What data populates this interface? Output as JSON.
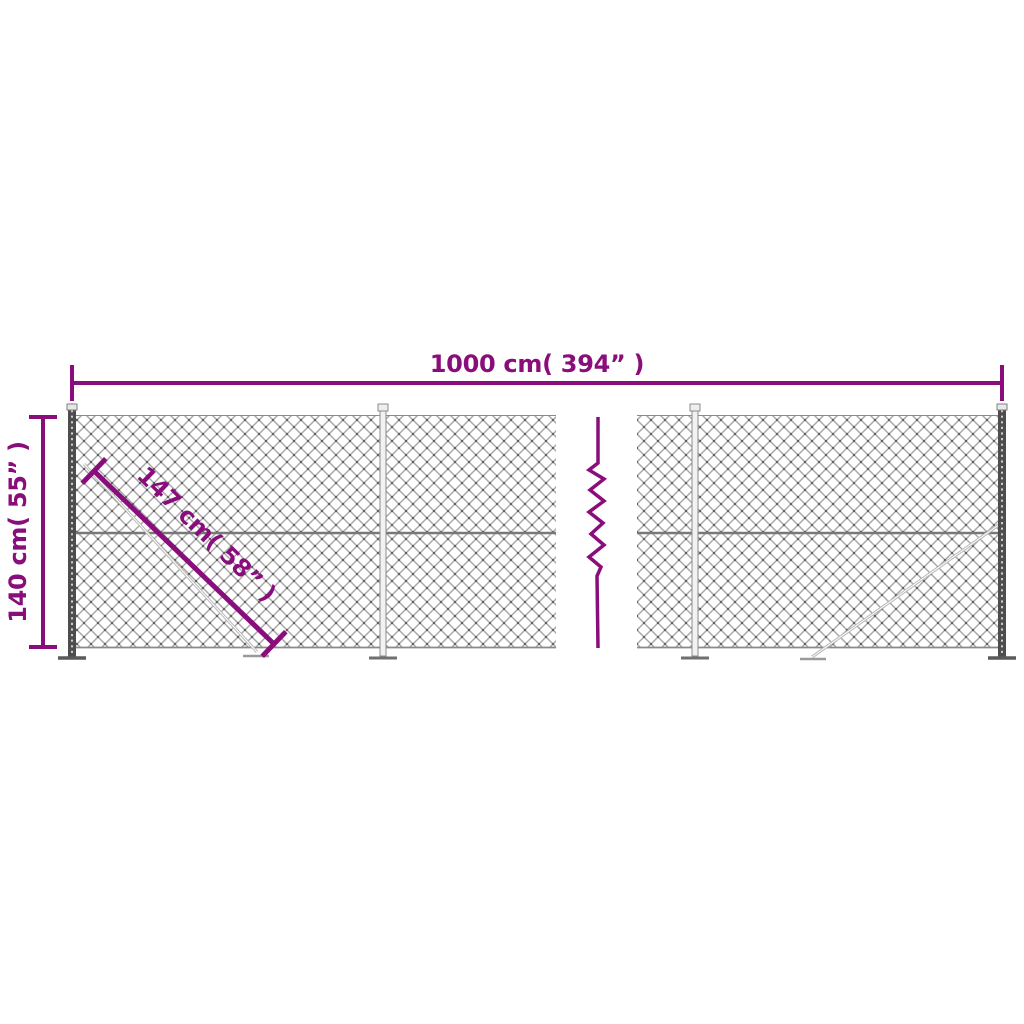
{
  "labels": {
    "width": "1000 cm( 394” )",
    "height": "140 cm( 55” )",
    "diagonal": "147 cm( 58” )"
  },
  "colors": {
    "dimension": "#8a0d7c",
    "mesh_line": "#a8a8a8",
    "mesh_node": "#5a5a5a",
    "rail": "#787878",
    "edge": "#8a8a8a",
    "post_dark": "#4d4d4d",
    "post_light": "#f2f2f2",
    "post_stroke": "#8c8c8c",
    "brace": "#b8b8b8",
    "background": "#ffffff"
  }
}
